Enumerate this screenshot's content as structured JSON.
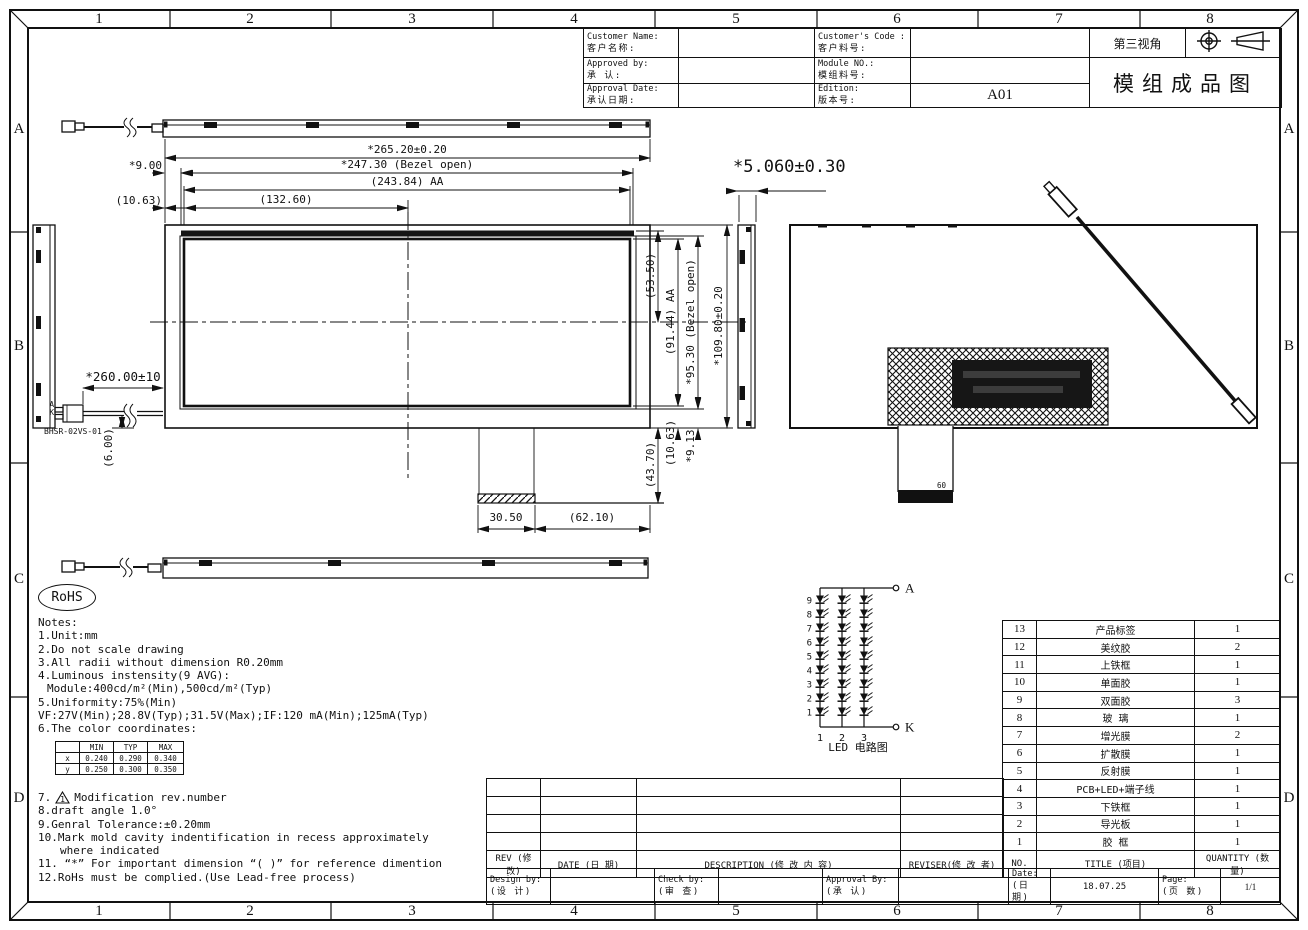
{
  "frame": {
    "cols": [
      "1",
      "2",
      "3",
      "4",
      "5",
      "6",
      "7",
      "8"
    ],
    "rows": [
      "A",
      "B",
      "C",
      "D"
    ]
  },
  "title_block": {
    "customer_name_label": "Customer Name:",
    "customer_name_label_cn": "客户名称:",
    "customer_code_label": "Customer's Code :",
    "customer_code_label_cn": "客户料号:",
    "approved_by_label": "Approved by:",
    "approved_by_label_cn": "承 认:",
    "module_no_label": "Module NO.:",
    "module_no_label_cn": "模组料号:",
    "approval_date_label": "Approval Date:",
    "approval_date_label_cn": "承认日期:",
    "edition_label": "Edition:",
    "edition_label_cn": "版本号:",
    "edition_value": "A01",
    "projection_label": "第三视角",
    "drawing_title": "模组成品图"
  },
  "dims": {
    "width_total": "*265.20±0.20",
    "width_bezel": "*247.30 (Bezel open)",
    "width_aa": "(243.84) AA",
    "width_half": "(132.60)",
    "edge_left": "*9.00",
    "edge_left2": "(10.63)",
    "height_total": "*109.80±0.20",
    "height_bezel": "*95.30 (Bezel open)",
    "height_aa": "(91.44) AA",
    "height_top": "(53.50)",
    "bottom_a": "(43.70)",
    "bottom_b": "(10.63)",
    "bottom_c": "*9.13",
    "label_width": "30.50",
    "label_offset": "(62.10)",
    "wire_length": "*260.00±10",
    "wire_exit": "(6.00)",
    "thickness": "*5.060±0.30"
  },
  "connector": {
    "part_no": "BHSR-02VS-01",
    "pin_a": "A",
    "pin_k": "K"
  },
  "fpc_marking": "60",
  "rohs": "RoHS",
  "notes": {
    "lines1": [
      "Notes:",
      "1.Unit:mm",
      "2.Do not scale drawing",
      "3.All radii without dimension R0.20mm",
      "4.Luminous instensity(9 AVG):",
      "Module:400cd/m²(Min),500cd/m²(Typ)",
      "5.Uniformity:75%(Min)",
      "VF:27V(Min);28.8V(Typ);31.5V(Max);IF:120 mA(Min);125mA(Typ)",
      "6.The color coordinates:"
    ],
    "item7_prefix": "7.",
    "item7_marker": "1",
    "item7_text": "Modification rev.number",
    "lines2": [
      "8.draft angle 1.0°",
      "9.Genral Tolerance:±0.20mm",
      "10.Mark mold cavity indentification in recess approximately",
      "where indicated",
      "11. “*” For important dimension “( )” for reference dimention",
      "12.RoHs must be complied.(Use Lead-free process)"
    ]
  },
  "color_table": {
    "headers": [
      "",
      "MIN",
      "TYP",
      "MAX"
    ],
    "rows": [
      {
        "name": "x",
        "min": "0.240",
        "typ": "0.290",
        "max": "0.340"
      },
      {
        "name": "y",
        "min": "0.250",
        "typ": "0.300",
        "max": "0.350"
      }
    ]
  },
  "led_circuit": {
    "strings": 3,
    "leds_per_string": 9,
    "anode": "A",
    "cathode": "K",
    "rows": [
      "9",
      "8",
      "7",
      "6",
      "5",
      "4",
      "3",
      "2",
      "1"
    ],
    "cols": [
      "1",
      "2",
      "3"
    ],
    "caption": "LED 电路图"
  },
  "bom": {
    "header": {
      "no": "NO.",
      "title": "TITLE (项目)",
      "qty": "QUANTITY (数 量)"
    },
    "rows": [
      {
        "no": "13",
        "title": "产品标签",
        "qty": "1"
      },
      {
        "no": "12",
        "title": "美纹胶",
        "qty": "2"
      },
      {
        "no": "11",
        "title": "上铁框",
        "qty": "1"
      },
      {
        "no": "10",
        "title": "单面胶",
        "qty": "1"
      },
      {
        "no": "9",
        "title": "双面胶",
        "qty": "3"
      },
      {
        "no": "8",
        "title": "玻 璃",
        "qty": "1"
      },
      {
        "no": "7",
        "title": "增光膜",
        "qty": "2"
      },
      {
        "no": "6",
        "title": "扩散膜",
        "qty": "1"
      },
      {
        "no": "5",
        "title": "反射膜",
        "qty": "1"
      },
      {
        "no": "4",
        "title": "PCB+LED+端子线",
        "qty": "1"
      },
      {
        "no": "3",
        "title": "下铁框",
        "qty": "1"
      },
      {
        "no": "2",
        "title": "导光板",
        "qty": "1"
      },
      {
        "no": "1",
        "title": "胶 框",
        "qty": "1"
      }
    ]
  },
  "revision": {
    "rev": "REV (修改)",
    "date": "DATE (日 期)",
    "description": "DESCRIPTION (修 改 内 容)",
    "reviser": "REVISER(修 改 者)"
  },
  "approval": {
    "design_by": "Design by:",
    "design_by_cn": "(设 计)",
    "check_by": "Check by:",
    "check_by_cn": "(审 查)",
    "approval_by": "Approval By:",
    "approval_by_cn": "(承 认)",
    "date_label": "Date:",
    "date_label_cn": "(日 期)",
    "date_value": "18.07.25",
    "page_label": "Page:",
    "page_label_cn": "(页 数)",
    "page_value": "1/1"
  }
}
